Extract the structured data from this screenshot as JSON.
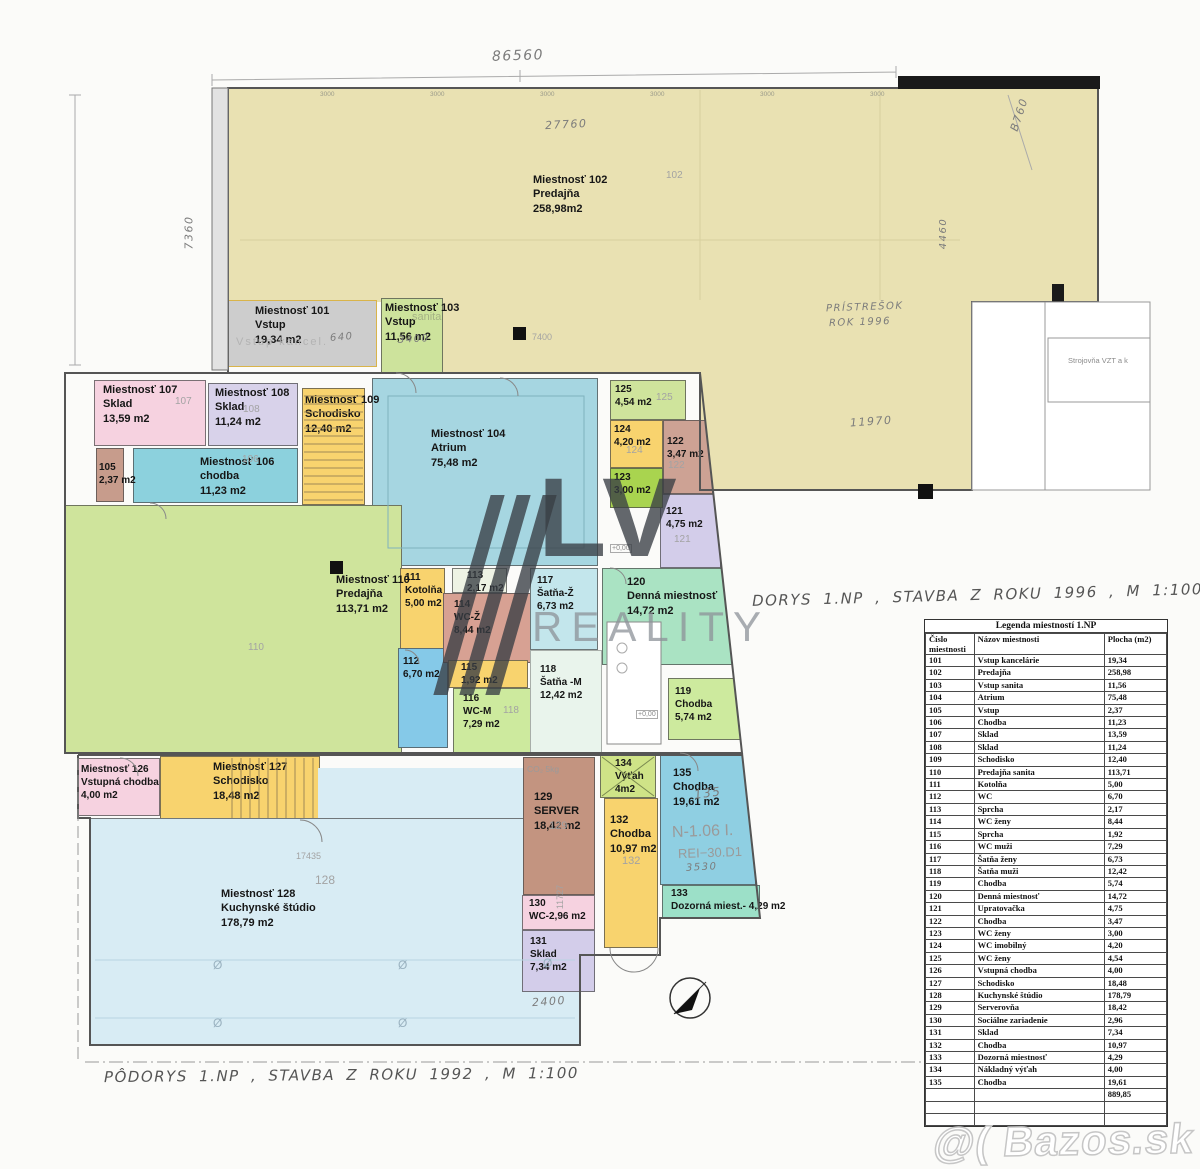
{
  "rooms": [
    {
      "id": "r102a",
      "lines": [
        "Miestnosť 102",
        "Predajňa",
        "258,98m2"
      ]
    },
    {
      "id": "r102b",
      "lines": []
    },
    {
      "id": "r102c",
      "lines": []
    },
    {
      "id": "r101",
      "lines": [
        "Miestnosť 101",
        "Vstup",
        "19,34 m2"
      ]
    },
    {
      "id": "r103",
      "lines": [
        "Miestnosť 103",
        "Vstup",
        "11,56 m2"
      ]
    },
    {
      "id": "r104",
      "lines": [
        "Miestnosť 104",
        "Atrium",
        "75,48 m2"
      ]
    },
    {
      "id": "r105",
      "lines": [
        "105",
        "2,37 m2"
      ]
    },
    {
      "id": "r106",
      "lines": [
        "Miestnosť 106",
        "chodba",
        "11,23 m2"
      ]
    },
    {
      "id": "r107",
      "lines": [
        "Miestnosť 107",
        "Sklad",
        "13,59 m2"
      ]
    },
    {
      "id": "r108",
      "lines": [
        "Miestnosť 108",
        "Sklad",
        "11,24 m2"
      ]
    },
    {
      "id": "r109",
      "lines": [
        "Miestnosť 109",
        "Schodisko",
        "12,40 m2"
      ]
    },
    {
      "id": "r110",
      "lines": [
        "Miestnosť 110",
        "Predajňa",
        "113,71 m2"
      ]
    },
    {
      "id": "r111",
      "lines": [
        "111",
        "Kotolňa",
        "5,00 m2"
      ]
    },
    {
      "id": "r112",
      "lines": [
        "112",
        "6,70 m2"
      ]
    },
    {
      "id": "r113",
      "lines": [
        "113",
        "2,17 m2"
      ]
    },
    {
      "id": "r114",
      "lines": [
        "114",
        "WC-Ž",
        "8,44 m2"
      ]
    },
    {
      "id": "r115",
      "lines": [
        "115",
        "1,92 m2"
      ]
    },
    {
      "id": "r116",
      "lines": [
        "116",
        "WC-M",
        "7,29 m2"
      ]
    },
    {
      "id": "r117",
      "lines": [
        "117",
        "Šatňa-Ž",
        "6,73 m2"
      ]
    },
    {
      "id": "r118",
      "lines": [
        "118",
        "Šatňa -M",
        "12,42 m2"
      ]
    },
    {
      "id": "r119",
      "lines": [
        "119",
        "Chodba",
        "5,74 m2"
      ]
    },
    {
      "id": "r120",
      "lines": [
        "120",
        "Denná miestnosť",
        "14,72 m2"
      ]
    },
    {
      "id": "r121",
      "lines": [
        "121",
        "4,75 m2"
      ]
    },
    {
      "id": "r122",
      "lines": [
        "122",
        "3,47 m2"
      ]
    },
    {
      "id": "r123",
      "lines": [
        "123",
        "3,00 m2"
      ]
    },
    {
      "id": "r124",
      "lines": [
        "124",
        "4,20 m2"
      ]
    },
    {
      "id": "r125",
      "lines": [
        "125",
        "4,54 m2"
      ]
    },
    {
      "id": "r126",
      "lines": [
        "Miestnosť 126",
        "Vstupná chodba",
        "4,00 m2"
      ]
    },
    {
      "id": "r127",
      "lines": [
        "Miestnosť 127",
        "Schodisko",
        "18,48 m2"
      ]
    },
    {
      "id": "r128a",
      "lines": []
    },
    {
      "id": "r128",
      "lines": [
        "Miestnosť 128",
        "Kuchynské štúdio",
        "178,79 m2"
      ]
    },
    {
      "id": "r129",
      "lines": [
        "129",
        "SERVER",
        "18,42 m2"
      ]
    },
    {
      "id": "r130",
      "lines": [
        "130",
        "WC-2,96 m2"
      ]
    },
    {
      "id": "r131",
      "lines": [
        "131",
        "Sklad",
        "7,34 m2"
      ]
    },
    {
      "id": "r132",
      "lines": [
        "132",
        "Chodba",
        "10,97 m2"
      ]
    },
    {
      "id": "r133",
      "lines": [
        "133",
        "Dozorná miest.- 4,29 m2"
      ]
    },
    {
      "id": "r134",
      "lines": [
        "134",
        "Výťah",
        "4m2"
      ]
    },
    {
      "id": "r135",
      "lines": [
        "135",
        "Chodba",
        "19,61 m2"
      ]
    }
  ],
  "notes": [
    {
      "id": "dimtop",
      "kind": "hw",
      "text": "86560"
    },
    {
      "id": "d27760",
      "kind": "hw",
      "text": "27760"
    },
    {
      "id": "b760",
      "kind": "hw",
      "text": "B760"
    },
    {
      "id": "d7360",
      "kind": "hw",
      "text": "7360"
    },
    {
      "id": "d11970",
      "kind": "hw",
      "text": "11970"
    },
    {
      "id": "d4460",
      "kind": "hw",
      "text": "4460"
    },
    {
      "id": "d2400",
      "kind": "hw",
      "text": "2400"
    },
    {
      "id": "d3530",
      "kind": "hw",
      "text": "3530"
    },
    {
      "id": "pris1",
      "kind": "hw",
      "text": "PRÍSTREŠOK"
    },
    {
      "id": "pris2",
      "kind": "hw",
      "text": "ROK 1996"
    },
    {
      "id": "n135",
      "kind": "hw",
      "text": "135"
    },
    {
      "id": "n640",
      "kind": "hw",
      "text": "640"
    },
    {
      "id": "n3400",
      "kind": "hw",
      "text": "3400"
    },
    {
      "id": "t1996",
      "kind": "hw",
      "text": "DORYS 1.NP , STAVBA Z ROKU 1996 , M 1:100"
    },
    {
      "id": "t1992",
      "kind": "hw",
      "text": "PÔDORYS 1.NP , STAVBA Z ROKU 1992 , M 1:100"
    },
    {
      "id": "vkancel",
      "kind": "fl",
      "text": "Vstup  kancel."
    },
    {
      "id": "sanita",
      "kind": "fl",
      "text": "sanita"
    },
    {
      "id": "stroj",
      "kind": "fl",
      "text": "Strojovňa VZT a k"
    },
    {
      "id": "n106",
      "kind": "fl",
      "text": "N-1.06 I."
    },
    {
      "id": "rei",
      "kind": "fl",
      "text": "REI−30.D1"
    },
    {
      "id": "co2",
      "kind": "fl",
      "text": "CO₂ 5kg"
    },
    {
      "id": "d17435",
      "kind": "fl",
      "text": "17435"
    },
    {
      "id": "d11727",
      "kind": "fl",
      "text": "11727"
    },
    {
      "id": "d7400",
      "kind": "fl",
      "text": "7400"
    },
    {
      "id": "f102",
      "kind": "fl",
      "text": "102"
    },
    {
      "id": "f107",
      "kind": "fl",
      "text": "107"
    },
    {
      "id": "f108",
      "kind": "fl",
      "text": "108"
    },
    {
      "id": "f106",
      "kind": "fl",
      "text": "106"
    },
    {
      "id": "f110",
      "kind": "fl",
      "text": "110"
    },
    {
      "id": "f118",
      "kind": "fl",
      "text": "118"
    },
    {
      "id": "f121",
      "kind": "fl",
      "text": "121"
    },
    {
      "id": "f122",
      "kind": "fl",
      "text": "122"
    },
    {
      "id": "f124",
      "kind": "fl",
      "text": "124"
    },
    {
      "id": "f125",
      "kind": "fl",
      "text": "125"
    },
    {
      "id": "f128",
      "kind": "fl",
      "text": "128"
    },
    {
      "id": "f129",
      "kind": "fl",
      "text": "129"
    },
    {
      "id": "f132",
      "kind": "fl",
      "text": "132"
    },
    {
      "id": "p000a",
      "kind": "fl",
      "text": "+0,00"
    },
    {
      "id": "p000b",
      "kind": "fl",
      "text": "+0,00"
    },
    {
      "id": "o1",
      "kind": "fl",
      "text": "Ø"
    },
    {
      "id": "o2",
      "kind": "fl",
      "text": "Ø"
    },
    {
      "id": "o3",
      "kind": "fl",
      "text": "Ø"
    },
    {
      "id": "o4",
      "kind": "fl",
      "text": "Ø"
    },
    {
      "id": "o5",
      "kind": "fl",
      "text": "Ø"
    },
    {
      "id": "k1",
      "kind": "fl",
      "text": "3000"
    },
    {
      "id": "k2",
      "kind": "fl",
      "text": "3000"
    },
    {
      "id": "k3",
      "kind": "fl",
      "text": "3000"
    },
    {
      "id": "k4",
      "kind": "fl",
      "text": "3000"
    },
    {
      "id": "k5",
      "kind": "fl",
      "text": "3000"
    },
    {
      "id": "k6",
      "kind": "fl",
      "text": "3000"
    }
  ],
  "legend": {
    "title": "Legenda miestností 1.NP",
    "columns": [
      "Číslo miestnosti",
      "Názov miestnosti",
      "Plocha (m2)"
    ],
    "rows": [
      [
        "101",
        "Vstup kancelárie",
        "19,34"
      ],
      [
        "102",
        "Predajňa",
        "258,98"
      ],
      [
        "103",
        "Vstup sanita",
        "11,56"
      ],
      [
        "104",
        "Atrium",
        "75,48"
      ],
      [
        "105",
        "Vstup",
        "2,37"
      ],
      [
        "106",
        "Chodba",
        "11,23"
      ],
      [
        "107",
        "Sklad",
        "13,59"
      ],
      [
        "108",
        "Sklad",
        "11,24"
      ],
      [
        "109",
        "Schodisko",
        "12,40"
      ],
      [
        "110",
        "Predajňa sanita",
        "113,71"
      ],
      [
        "111",
        "Kotolňa",
        "5,00"
      ],
      [
        "112",
        "WC",
        "6,70"
      ],
      [
        "113",
        "Sprcha",
        "2,17"
      ],
      [
        "114",
        "WC ženy",
        "8,44"
      ],
      [
        "115",
        "Sprcha",
        "1,92"
      ],
      [
        "116",
        "WC muži",
        "7,29"
      ],
      [
        "117",
        "Šatňa ženy",
        "6,73"
      ],
      [
        "118",
        "Šatňa muži",
        "12,42"
      ],
      [
        "119",
        "Chodba",
        "5,74"
      ],
      [
        "120",
        "Denná miestnosť",
        "14,72"
      ],
      [
        "121",
        "Upratovačka",
        "4,75"
      ],
      [
        "122",
        "Chodba",
        "3,47"
      ],
      [
        "123",
        "WC ženy",
        "3,00"
      ],
      [
        "124",
        "WC imobilný",
        "4,20"
      ],
      [
        "125",
        "WC ženy",
        "4,54"
      ],
      [
        "126",
        "Vstupná chodba",
        "4,00"
      ],
      [
        "127",
        "Schodisko",
        "18,48"
      ],
      [
        "128",
        "Kuchynské štúdio",
        "178,79"
      ],
      [
        "129",
        "Serverovňa",
        "18,42"
      ],
      [
        "130",
        "Sociálne zariadenie",
        "2,96"
      ],
      [
        "131",
        "Sklad",
        "7,34"
      ],
      [
        "132",
        "Chodba",
        "10,97"
      ],
      [
        "133",
        "Dozorná miestnosť",
        "4,29"
      ],
      [
        "134",
        "Nákladný výťah",
        "4,00"
      ],
      [
        "135",
        "Chodba",
        "19,61"
      ],
      [
        "",
        "",
        "889,85"
      ],
      [
        "",
        "",
        ""
      ],
      [
        "",
        "",
        ""
      ]
    ]
  },
  "watermarks": {
    "logo_main": "LV",
    "logo_sub": "REALITY",
    "site": "@( Bazos.sk"
  }
}
